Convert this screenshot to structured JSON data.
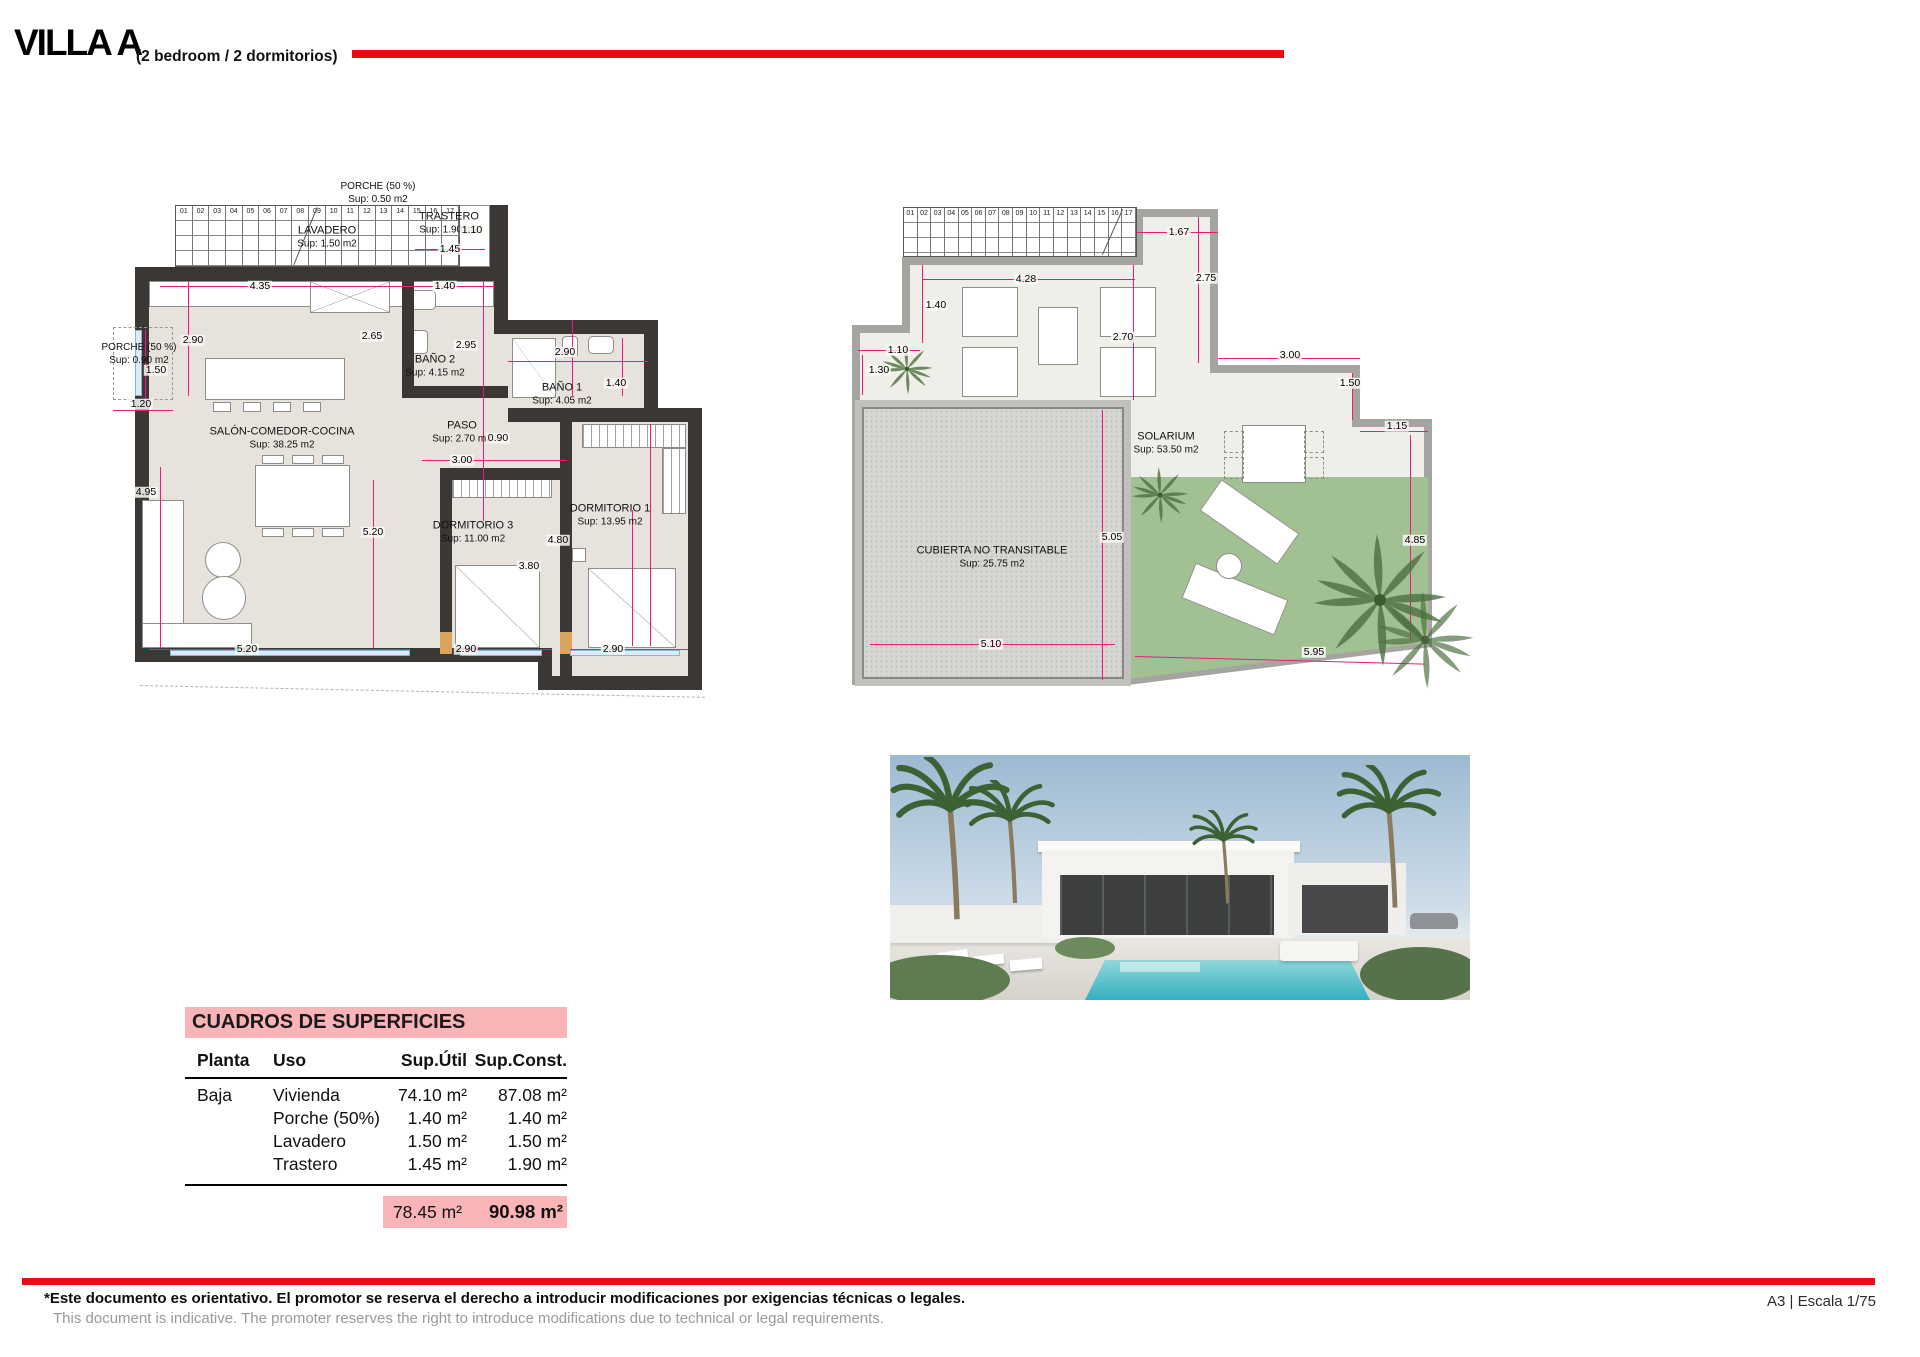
{
  "header": {
    "title": "VILLA A",
    "subtitle": "(2 bedroom / 2 dormitorios)"
  },
  "stairs": [
    "01",
    "02",
    "03",
    "04",
    "05",
    "06",
    "07",
    "08",
    "09",
    "10",
    "11",
    "12",
    "13",
    "14",
    "15",
    "16",
    "17"
  ],
  "plan_ground": {
    "labels": {
      "porche_top": {
        "name": "PORCHE (50 %)",
        "sup": "Sup: 0.50 m2"
      },
      "lavadero": {
        "name": "LAVADERO",
        "sup": "Sup: 1.50 m2"
      },
      "trastero": {
        "name": "TRASTERO",
        "sup": "Sup: 1.90 m2"
      },
      "porche_left": {
        "name": "PORCHE (50 %)",
        "sup": "Sup: 0.90 m2"
      },
      "salon": {
        "name": "SALÓN-COMEDOR-COCINA",
        "sup": "Sup: 38.25 m2"
      },
      "bano2": {
        "name": "BAÑO 2",
        "sup": "Sup: 4.15 m2"
      },
      "bano1": {
        "name": "BAÑO 1",
        "sup": "Sup: 4.05 m2"
      },
      "paso": {
        "name": "PASO",
        "sup": "Sup: 2.70 m2"
      },
      "dorm3": {
        "name": "DORMITORIO 3",
        "sup": "Sup: 11.00 m2"
      },
      "dorm1": {
        "name": "DORMITORIO 1",
        "sup": "Sup: 13.95 m2"
      }
    },
    "dims": [
      "4.35",
      "1.40",
      "1.10",
      "1.45",
      "2.90",
      "2.65",
      "2.95",
      "2.90",
      "1.40",
      "1.50",
      "1.20",
      "0.90",
      "3.00",
      "4.95",
      "5.20",
      "4.80",
      "3.80",
      "5.20",
      "2.90",
      "2.90"
    ]
  },
  "plan_roof": {
    "labels": {
      "solarium": {
        "name": "SOLARIUM",
        "sup": "Sup: 53.50 m2"
      },
      "cubierta": {
        "name": "CUBIERTA NO TRANSITABLE",
        "sup": "Sup: 25.75 m2"
      }
    },
    "dims": [
      "1.67",
      "4.28",
      "1.40",
      "2.70",
      "1.10",
      "1.30",
      "2.75",
      "3.00",
      "1.50",
      "1.15",
      "4.85",
      "5.05",
      "5.10",
      "5.95"
    ]
  },
  "table": {
    "title": "CUADROS DE SUPERFICIES",
    "columns": [
      "Planta",
      "Uso",
      "Sup.Útil",
      "Sup.Const."
    ],
    "rows": [
      {
        "planta": "Baja",
        "uso": "Vivienda",
        "util": "74.10 m²",
        "const": "87.08 m²"
      },
      {
        "planta": "",
        "uso": "Porche (50%)",
        "util": "1.40 m²",
        "const": "1.40 m²"
      },
      {
        "planta": "",
        "uso": "Lavadero",
        "util": "1.50 m²",
        "const": "1.50 m²"
      },
      {
        "planta": "",
        "uso": "Trastero",
        "util": "1.45 m²",
        "const": "1.90 m²"
      }
    ],
    "total": {
      "util": "78.45 m²",
      "const": "90.98 m²"
    }
  },
  "footer": {
    "disclaimer_es": "*Este documento es orientativo. El promotor se reserva el derecho a introducir modificaciones por exigencias técnicas o legales.",
    "disclaimer_en": "This document is indicative. The promoter reserves the right to introduce modifications due to technical or legal requirements.",
    "sheet_info": "A3 | Escala 1/75"
  },
  "colors": {
    "accent_red": "#e60e13",
    "dimension_pink": "#ef1880",
    "table_pink": "#f9b4b8",
    "wall_dark": "#3a3734",
    "roof_wall_gray": "#a6a4a0",
    "lawn_green": "#a2c193",
    "floor_beige": "#e7e2db"
  }
}
